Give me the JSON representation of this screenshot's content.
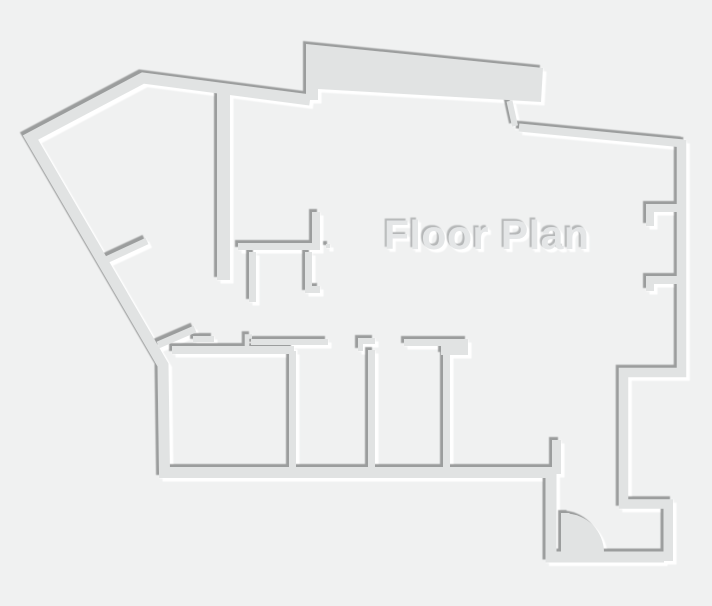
{
  "title": "Floor Plan",
  "colors": {
    "background": "#f0f1f1",
    "wall": "#e1e3e3",
    "shadow_dark": "#9b9d9d",
    "shadow_light": "#ffffff",
    "text_fill": "#e4e6e7",
    "text_shadow_dark": "#b5b7b8"
  },
  "door": {
    "symbol": "quarter-circle-swing"
  }
}
